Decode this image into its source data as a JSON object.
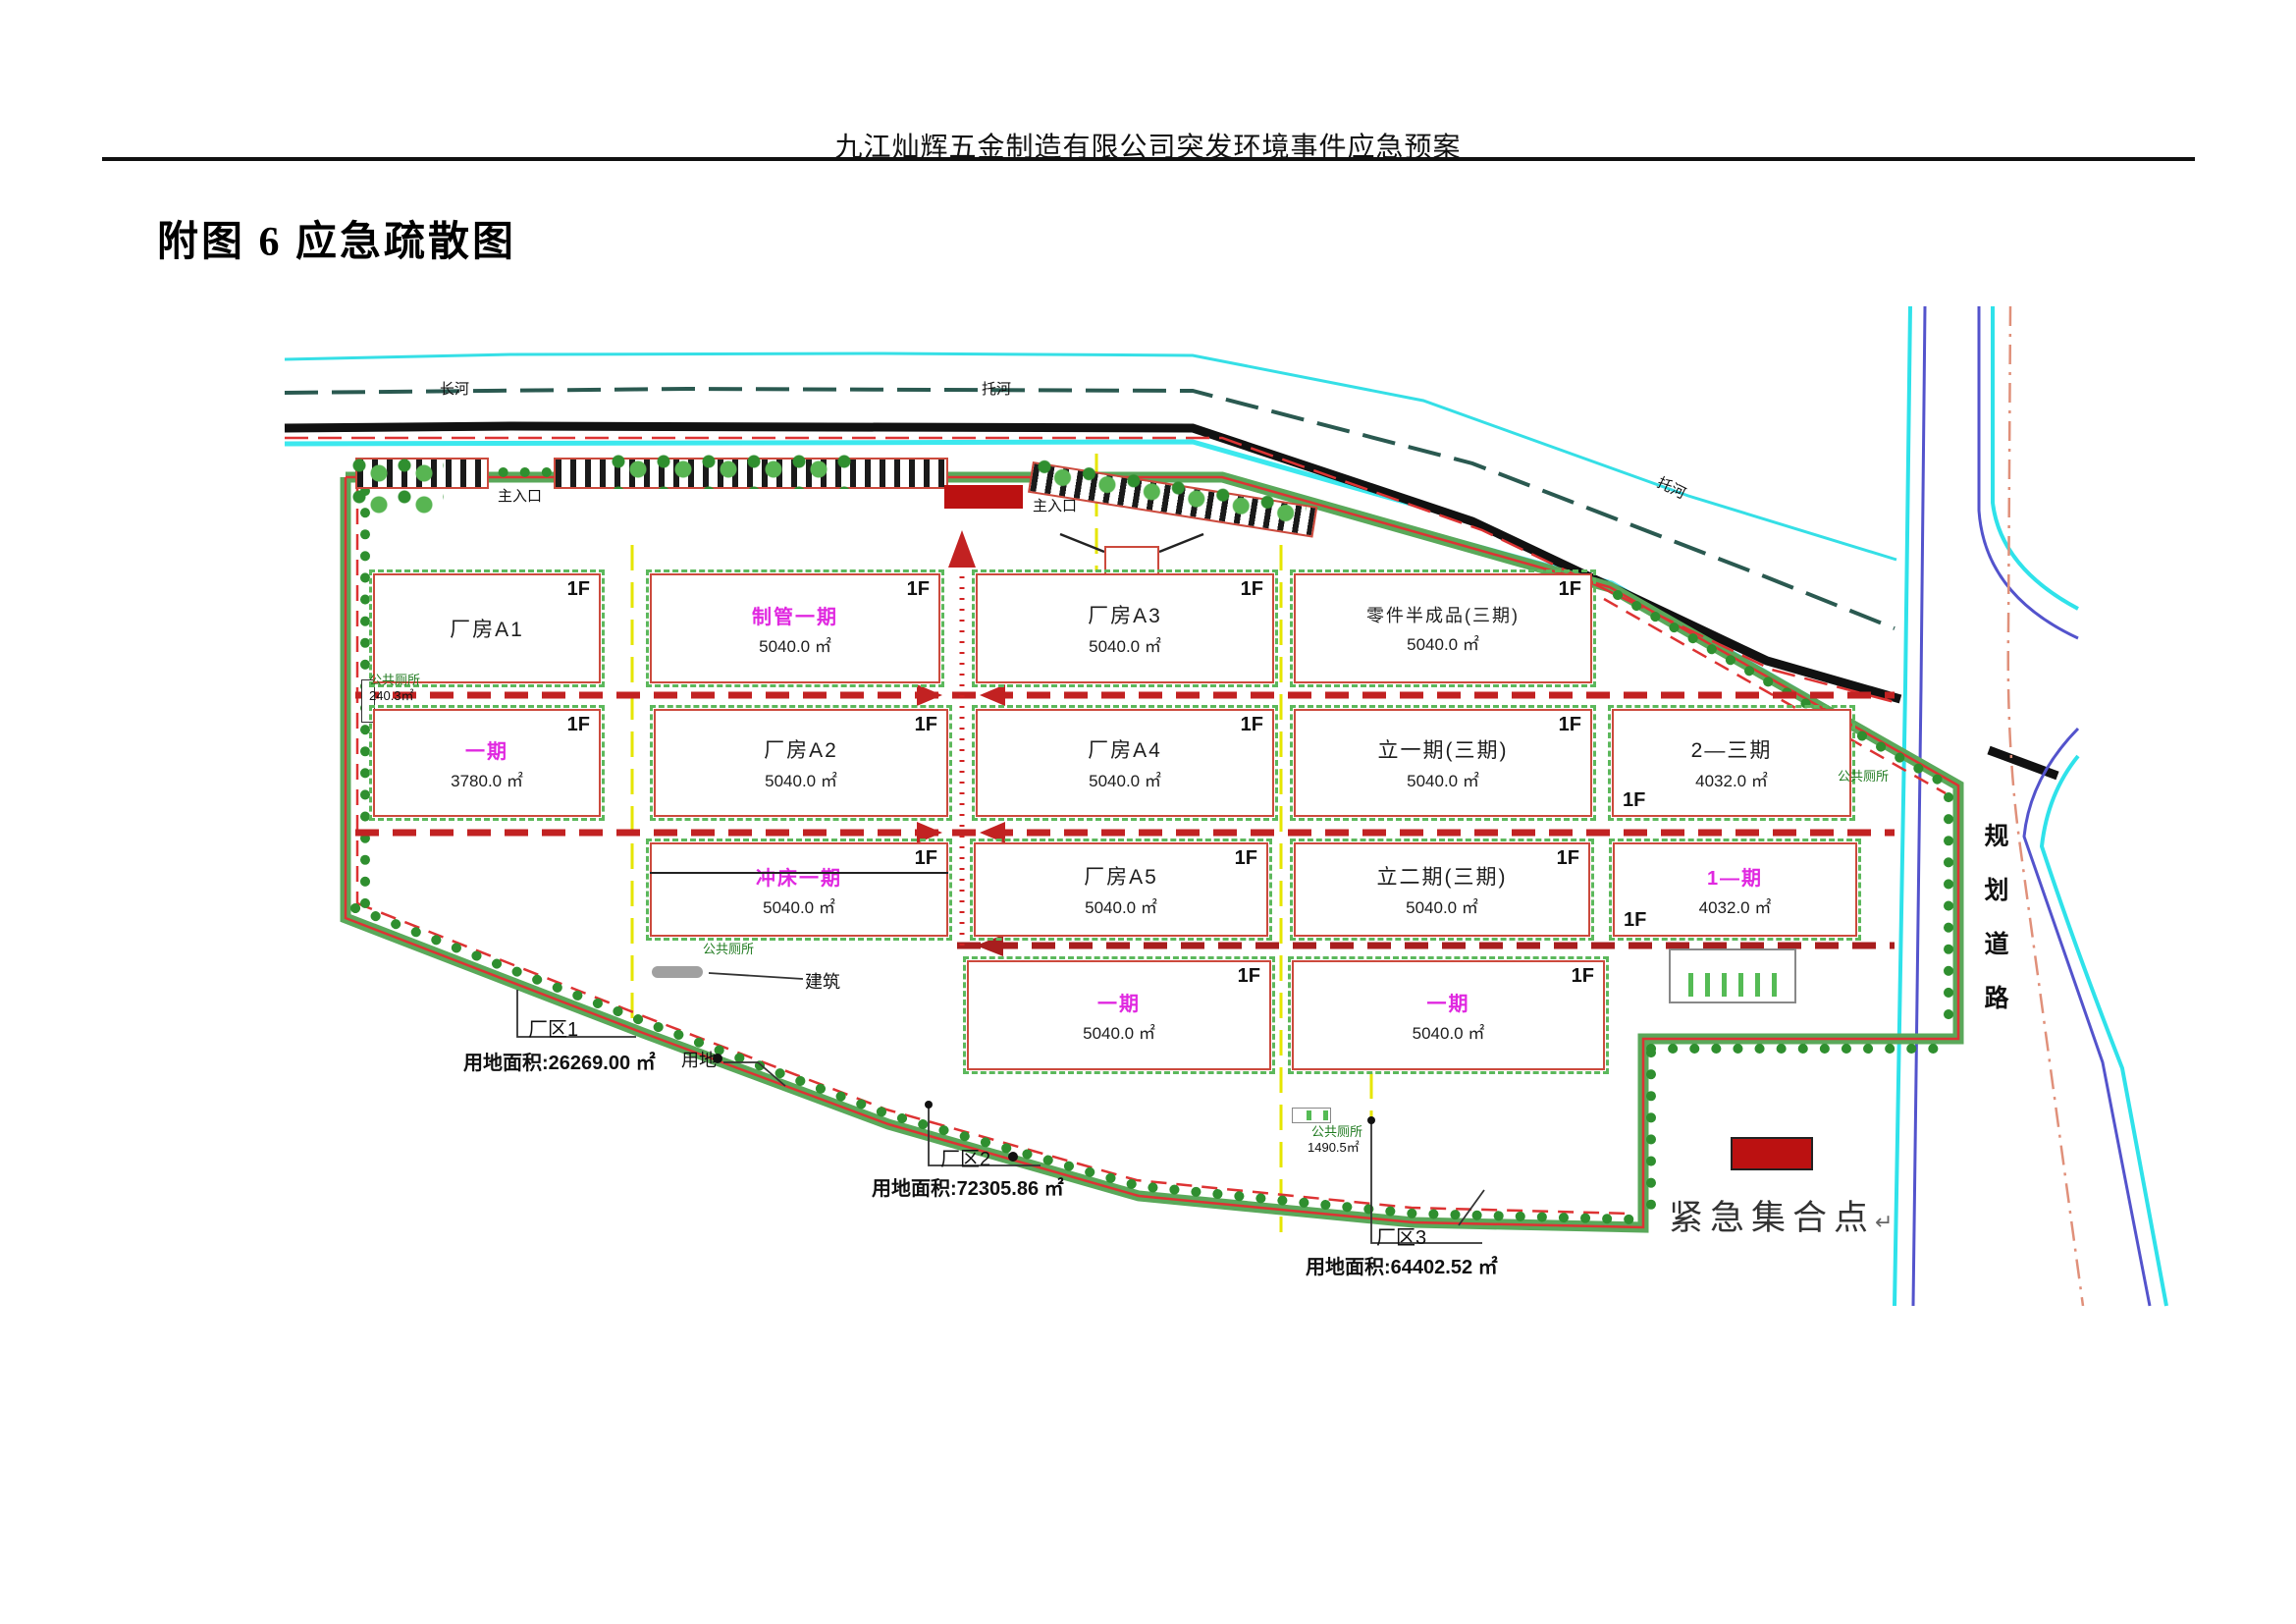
{
  "page": {
    "header": "九江灿辉五金制造有限公司突发环境事件应急预案",
    "title": "附图 6 应急疏散图"
  },
  "map": {
    "floor_label": "1F",
    "waterways": {
      "r1": "长河",
      "r2": "托河",
      "r3": "托河"
    },
    "road_vertical": "规划道路",
    "entrances": {
      "e1": "主入口",
      "e2": "主入口"
    },
    "buildings": [
      {
        "name": "厂房A1",
        "area": ""
      },
      {
        "name": "制管一期",
        "area": "5040.0 ㎡"
      },
      {
        "name": "厂房A3",
        "area": "5040.0 ㎡"
      },
      {
        "name": "零件半成品(三期)",
        "area": "5040.0 ㎡"
      },
      {
        "name": "一期",
        "area": "3780.0 ㎡"
      },
      {
        "name": "厂房A2",
        "area": "5040.0 ㎡"
      },
      {
        "name": "厂房A4",
        "area": "5040.0 ㎡"
      },
      {
        "name": "立一期(三期)",
        "area": "5040.0 ㎡"
      },
      {
        "name": "2—三期",
        "area": "4032.0 ㎡"
      },
      {
        "name": "冲床一期",
        "area": "5040.0 ㎡"
      },
      {
        "name": "厂房A5",
        "area": "5040.0 ㎡"
      },
      {
        "name": "立二期(三期)",
        "area": "5040.0 ㎡"
      },
      {
        "name": "1—期",
        "area": "4032.0 ㎡"
      },
      {
        "name": "一期",
        "area": "5040.0 ㎡"
      },
      {
        "name": "一期",
        "area": "5040.0 ㎡"
      }
    ],
    "zones": {
      "z1_name": "厂区1",
      "z1_area": "用地面积:26269.00 ㎡",
      "z2_name": "厂区2",
      "z2_area": "用地面积:72305.86 ㎡",
      "z3_name": "厂区3",
      "z3_area": "用地面积:64402.52 ㎡"
    },
    "misc": {
      "land_label": "用地",
      "building_label": "建筑",
      "toilet": "公共厕所",
      "toilet1_area": "240.3㎡",
      "toilet3_area": "1490.5㎡"
    },
    "assembly": {
      "label": "紧急集合点",
      "return_mark": "↵",
      "color": "#bb1111"
    }
  }
}
